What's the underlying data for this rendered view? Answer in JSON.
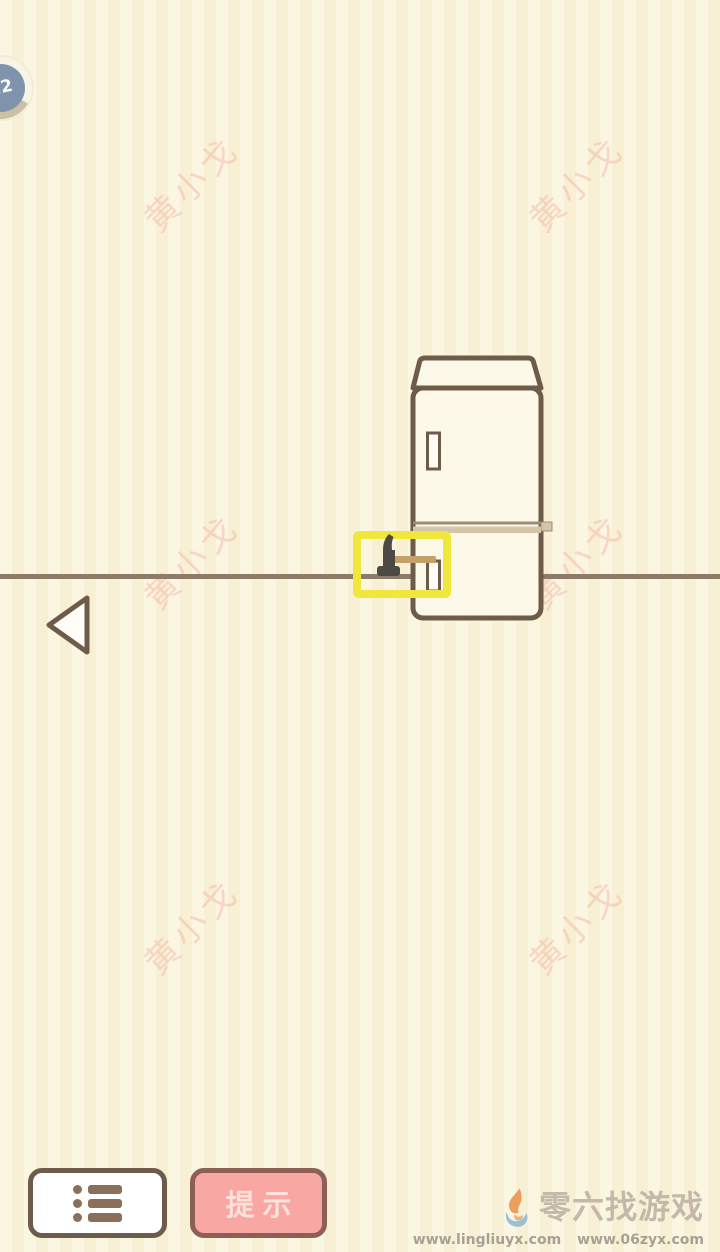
{
  "app": {
    "screen": "escape-puzzle-level",
    "description": "cream room with refrigerator, hammer highlighted by hint box"
  },
  "badge": {
    "level": "22"
  },
  "watermark": {
    "text": "黄小戈"
  },
  "scene": {
    "objects": [
      "refrigerator",
      "hammer",
      "floor-line"
    ],
    "highlight_color": "#F0E63C"
  },
  "buttons": {
    "menu_icon": "list-icon",
    "back_icon": "back-arrow-icon",
    "hint_label": "提示"
  },
  "site": {
    "logo_icon": "flame-swirl-logo",
    "name": "零六找游戏",
    "url1": "www.lingliuyx.com",
    "url2": "www.06zyx.com"
  },
  "colors": {
    "background_light": "#FBF6E1",
    "background_dark": "#F7F0D5",
    "outline_brown": "#6F5B49",
    "fridge_fill": "#FCF9E9",
    "floor_line": "#8D7B6A",
    "divider_band": "#D2C5A9",
    "highlight_yellow": "#F0E63C",
    "hammer_head": "#4D4945",
    "hammer_handle": "#C4A06B",
    "watermark_pink": "#F3B0A2",
    "badge_inner": "#7F94AC",
    "badge_ring_tan": "#CBBFA6",
    "hint_button_fill": "#F8A7A3",
    "hint_button_border": "#8D6057",
    "hint_button_text": "#FCE0DA",
    "site_name_color": "#C3B8A9",
    "site_url_color": "#A9A092"
  }
}
